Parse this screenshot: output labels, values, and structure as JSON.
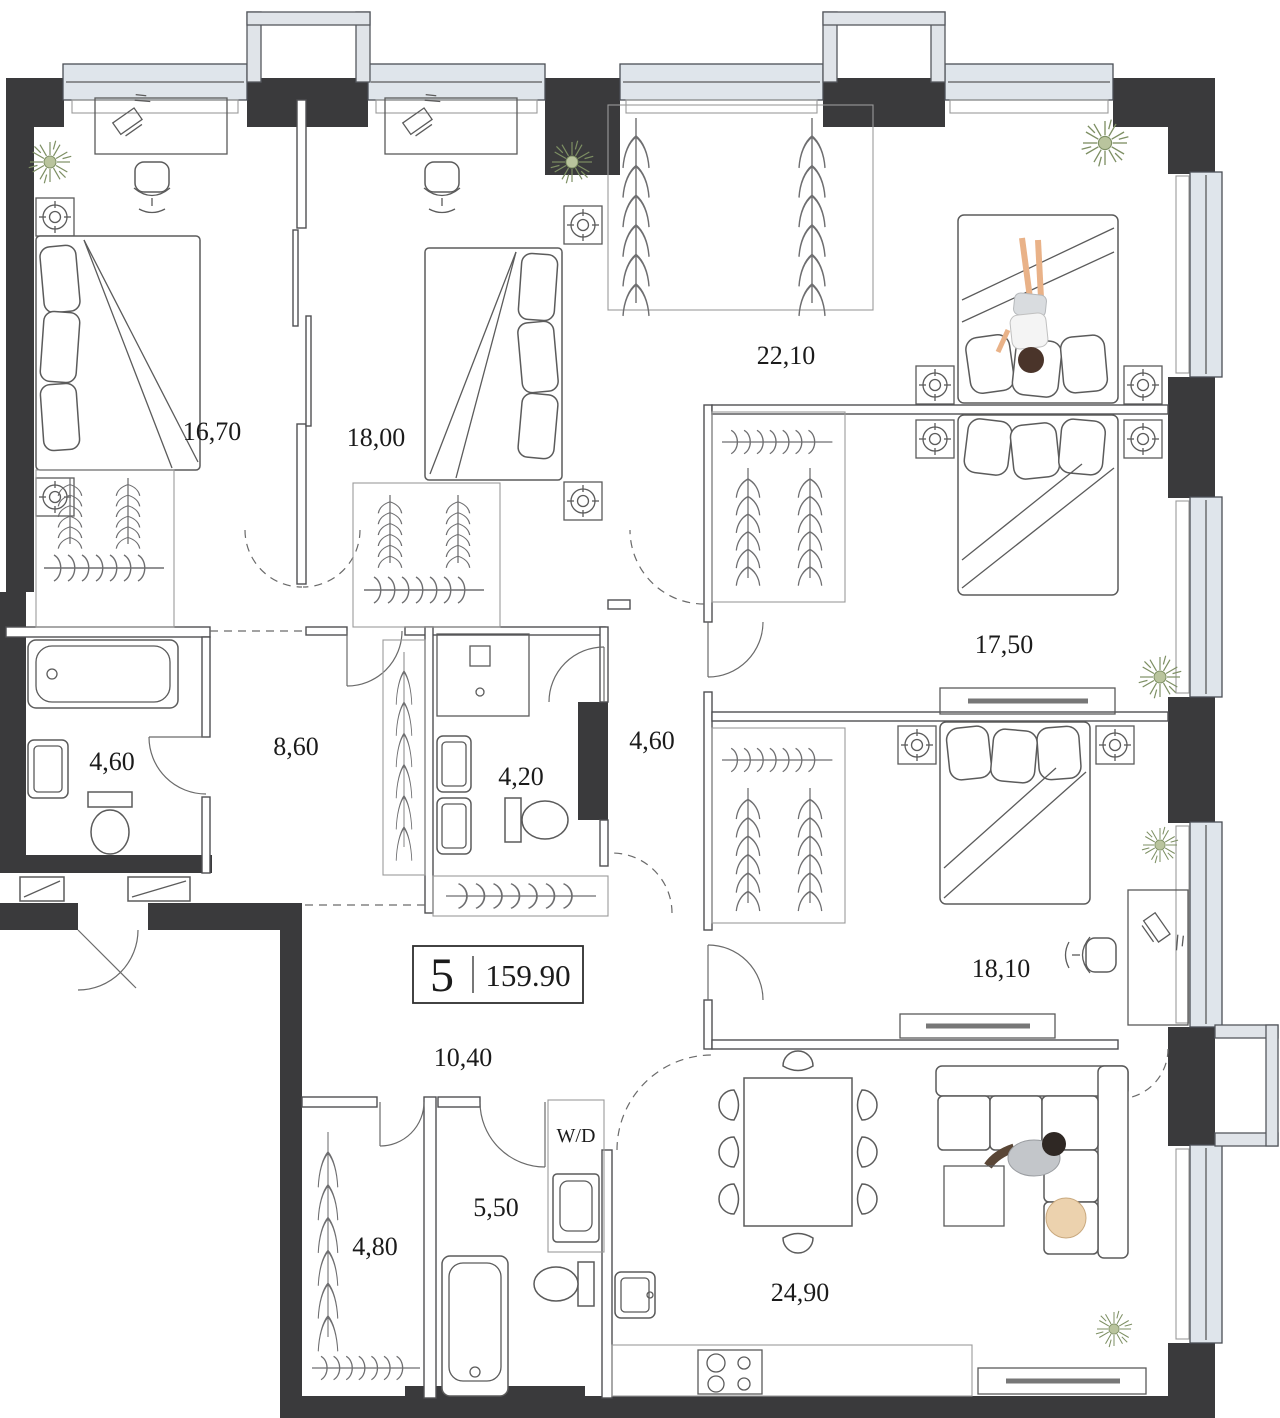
{
  "plan": {
    "unit": {
      "number": "5",
      "total_area": "159.90"
    },
    "labels": {
      "washer_dryer": "W/D"
    },
    "rooms": [
      {
        "name": "bedroom-1",
        "area": "16,70"
      },
      {
        "name": "bedroom-2",
        "area": "18,00"
      },
      {
        "name": "bedroom-3",
        "area": "22,10"
      },
      {
        "name": "bedroom-4",
        "area": "17,50"
      },
      {
        "name": "bathroom-1",
        "area": "4,60"
      },
      {
        "name": "hall",
        "area": "8,60"
      },
      {
        "name": "shower-room",
        "area": "4,20"
      },
      {
        "name": "hallway",
        "area": "4,60"
      },
      {
        "name": "bedroom-5",
        "area": "18,10"
      },
      {
        "name": "corridor",
        "area": "10,40"
      },
      {
        "name": "bathroom-2",
        "area": "5,50"
      },
      {
        "name": "wardrobe",
        "area": "4,80"
      },
      {
        "name": "living-kitchen",
        "area": "24,90"
      }
    ],
    "colors": {
      "wall": "#3a3a3c",
      "glass": "#dfe5eb",
      "accent_plant": "#7d8f63",
      "skin": "#e9b288",
      "hair": "#4a342a",
      "bag": "#ecd2ae"
    }
  }
}
